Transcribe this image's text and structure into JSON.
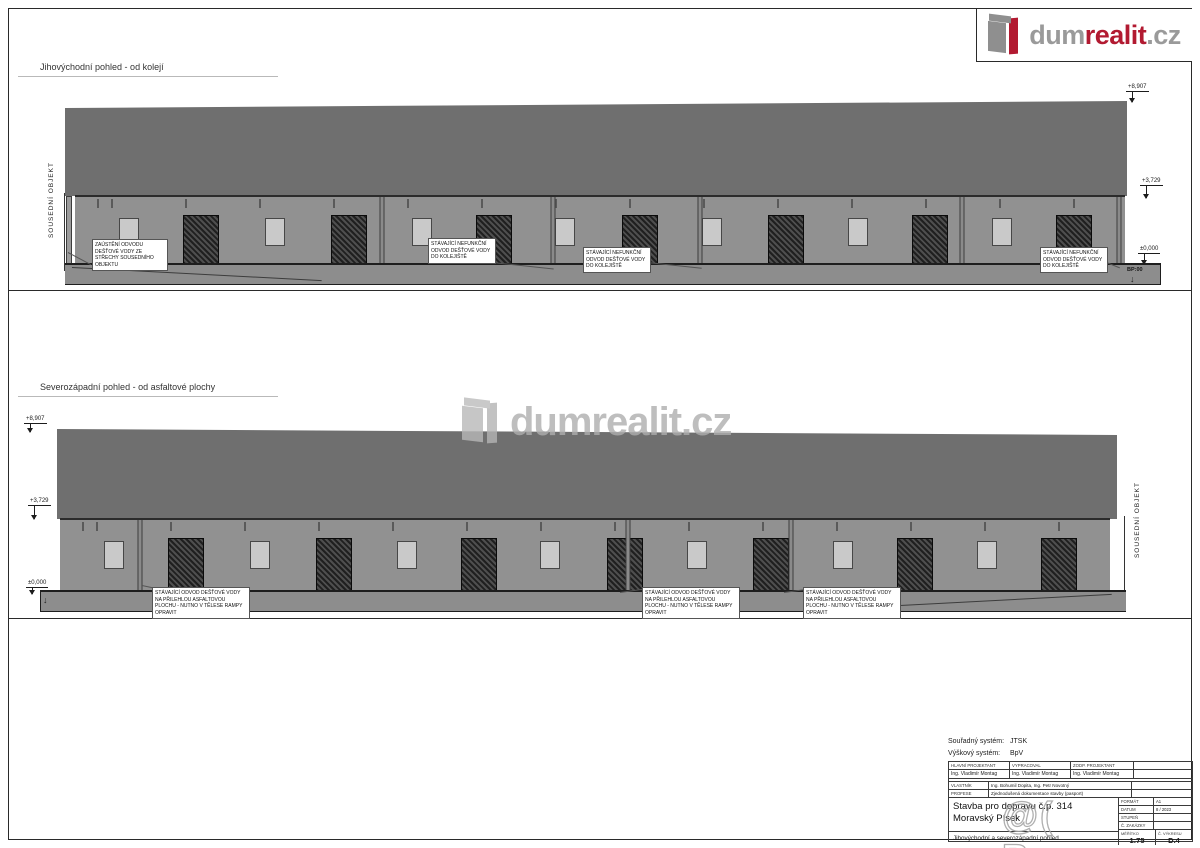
{
  "logo": {
    "part_gray1": "dum",
    "part_red": "realit",
    "part_gray2": ".cz"
  },
  "colors": {
    "roof": "#6f6f6f",
    "wall": "#919191",
    "ground": "#8d8d8d",
    "logo_red": "#b21a31",
    "logo_gray": "#9a9a9a"
  },
  "watermarks": {
    "center": "dumrealit.cz",
    "corner": "@( Bazos.cz"
  },
  "elevations": [
    {
      "title": "Jihovýchodní pohled - od kolejí",
      "side_label": "SOUSEDNÍ OBJEKT",
      "markers": [
        {
          "value": "+8,907"
        },
        {
          "value": "+3,729"
        },
        {
          "value": "±0,000"
        }
      ],
      "ground_label": "BP:00",
      "annotations": [
        {
          "text": "ZAÚSTĚNÍ ODVODU DEŠŤOVÉ VODY ZE STŘECHY SOUSEDNÍHO OBJEKTU"
        },
        {
          "text": "STÁVAJÍCÍ NEFUNKČNÍ ODVOD DEŠŤOVÉ VODY DO KOLEJIŠTĚ"
        },
        {
          "text": "STÁVAJÍCÍ NEFUNKČNÍ ODVOD DEŠŤOVÉ VODY DO KOLEJIŠTĚ"
        },
        {
          "text": "STÁVAJÍCÍ NEFUNKČNÍ ODVOD DEŠŤOVÉ VODY DO KOLEJIŠTĚ"
        }
      ],
      "facade": [
        {
          "t": "w",
          "x": 5.1
        },
        {
          "t": "d",
          "x": 12.0
        },
        {
          "t": "w",
          "x": 19.0
        },
        {
          "t": "d",
          "x": 26.1
        },
        {
          "t": "w",
          "x": 33.0
        },
        {
          "t": "d",
          "x": 39.9
        },
        {
          "t": "w",
          "x": 46.7
        },
        {
          "t": "d",
          "x": 53.8
        },
        {
          "t": "w",
          "x": 60.7
        },
        {
          "t": "d",
          "x": 67.7
        },
        {
          "t": "w",
          "x": 74.6
        },
        {
          "t": "d",
          "x": 81.4
        },
        {
          "t": "w",
          "x": 88.3
        },
        {
          "t": "d",
          "x": 95.1
        }
      ],
      "downpipes": [
        29.2,
        45.5,
        59.5,
        84.5,
        99.4
      ]
    },
    {
      "title": "Severozápadní pohled - od asfaltové plochy",
      "side_label": "SOUSEDNÍ OBJEKT",
      "markers": [
        {
          "value": "+8,907"
        },
        {
          "value": "+3,729"
        },
        {
          "value": "±0,000"
        }
      ],
      "annotations": [
        {
          "text": "STÁVAJÍCÍ ODVOD DEŠŤOVÉ VODY NA PŘILEHLOU ASFALTOVOU PLOCHU - NUTNO V TĚLESE RAMPY OPRAVIT"
        },
        {
          "text": "STÁVAJÍCÍ ODVOD DEŠŤOVÉ VODY NA PŘILEHLOU ASFALTOVOU PLOCHU - NUTNO V TĚLESE RAMPY OPRAVIT"
        },
        {
          "text": "STÁVAJÍCÍ ODVOD DEŠŤOVÉ VODY NA PŘILEHLOU ASFALTOVOU PLOCHU - NUTNO V TĚLESE RAMPY OPRAVIT"
        }
      ],
      "facade": [
        {
          "t": "w",
          "x": 5.1
        },
        {
          "t": "d",
          "x": 12.0
        },
        {
          "t": "w",
          "x": 19.0
        },
        {
          "t": "d",
          "x": 26.1
        },
        {
          "t": "w",
          "x": 33.0
        },
        {
          "t": "d",
          "x": 39.9
        },
        {
          "t": "w",
          "x": 46.7
        },
        {
          "t": "d",
          "x": 53.8
        },
        {
          "t": "w",
          "x": 60.7
        },
        {
          "t": "d",
          "x": 67.7
        },
        {
          "t": "w",
          "x": 74.6
        },
        {
          "t": "d",
          "x": 81.4
        },
        {
          "t": "w",
          "x": 88.3
        },
        {
          "t": "d",
          "x": 95.1
        }
      ],
      "downpipes": [
        7.6,
        54.1,
        69.6
      ]
    }
  ],
  "titleblock": {
    "coord_label": "Souřadný systém:",
    "coord_value": "JTSK",
    "height_label": "Výškový systém:",
    "height_value": "BpV",
    "roles": [
      {
        "label": "HLAVNÍ PROJEKTANT",
        "value": "Ing. Vladimír Montag"
      },
      {
        "label": "VYPRACOVAL",
        "value": "Ing. Vladimír Montag"
      },
      {
        "label": "ZODP. PROJEKTANT",
        "value": "Ing. Vladimír Montag"
      }
    ],
    "owner_label": "VLASTNÍK",
    "owner_value": "Ing. Bohumil Dopita, Ing. Petr Novotný",
    "profession_label": "PROFESE",
    "profession_value": "Zjednodušená dokumentace stavby (pasport)",
    "project_title": "Stavba pro dopravu č.p. 314 Moravský Písek",
    "drawing_title": "Jihovýchodní a severozápadní pohled",
    "meta": [
      {
        "label": "FORMÁT",
        "value": "A1"
      },
      {
        "label": "DATUM",
        "value": "8 / 2023"
      },
      {
        "label": "STUPEŇ",
        "value": ""
      },
      {
        "label": "Č. ZAKÁZKY",
        "value": ""
      }
    ],
    "scale_label": "MĚŘÍTKO",
    "scale_value": "1:75",
    "drawing_no_label": "Č. VÝKRESU",
    "drawing_no_value": "D.4"
  }
}
